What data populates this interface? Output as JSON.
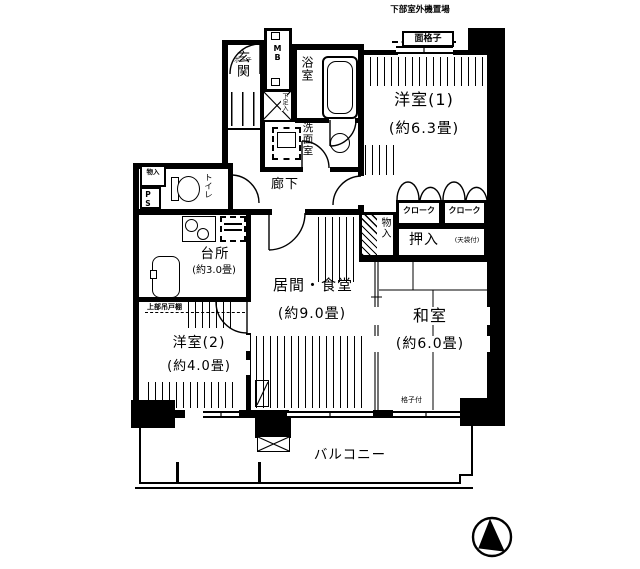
{
  "floorplan": {
    "top_note": "下部室外機置場",
    "grille_box": "面格子",
    "rooms": {
      "western1": {
        "name": "洋室(1)",
        "size": "(約6.3畳)"
      },
      "western2": {
        "name": "洋室(2)",
        "size": "(約4.0畳)"
      },
      "japanese": {
        "name": "和室",
        "size": "(約6.0畳)"
      },
      "living": {
        "name": "居間・食堂",
        "size": "(約9.0畳)"
      },
      "kitchen": {
        "name": "台所",
        "size": "(約3.0畳)"
      },
      "entrance": "玄関",
      "bath": "浴室",
      "washroom": "洗面室",
      "hallway": "廊下",
      "toilet": "トイレ",
      "balcony": "バルコニー",
      "porch": "ポーチ"
    },
    "storage": {
      "cloak1": "クローク",
      "cloak2": "クローク",
      "closet": "押入",
      "closet_note": "(天袋付)",
      "hall_storage": "物入",
      "small_storage": "物入",
      "pipe_space": "PS",
      "meter_box": "MB",
      "shoe_box": "下足入"
    },
    "notes": {
      "lattice": "格子付",
      "upper_shelf": "上部吊戸棚"
    },
    "icons": {
      "bathtub": "bathtub-icon",
      "toilet": "toilet-icon",
      "washbasin": "washbasin-icon",
      "washing_machine": "washing-machine-icon",
      "stove": "stove-icon",
      "sink": "kitchen-sink-icon",
      "refrigerator": "refrigerator-icon",
      "escape_hatch": "escape-hatch-icon",
      "compass": "compass-north-icon"
    },
    "colors": {
      "line": "#000000",
      "background": "#ffffff"
    }
  }
}
